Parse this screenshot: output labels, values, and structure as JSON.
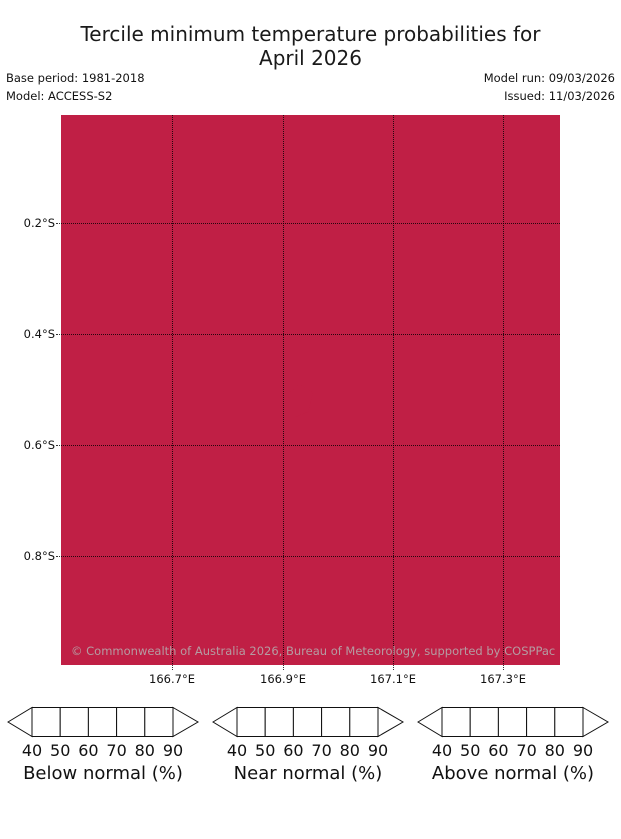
{
  "title": {
    "line1": "Tercile minimum temperature probabilities for",
    "line2": "April 2026"
  },
  "meta": {
    "base_period": "Base period: 1981-2018",
    "model": "Model: ACCESS-S2",
    "model_run": "Model run: 09/03/2026",
    "issued": "Issued: 11/03/2026"
  },
  "map": {
    "fill_color": "#c01f45",
    "outline_color": "#23131a",
    "attribution": "© Commonwealth of Australia 2026, Bureau of Meteorology, supported by COSPPac",
    "y_ticks": [
      "0.2°S",
      "0.4°S",
      "0.6°S",
      "0.8°S"
    ],
    "x_ticks": [
      "166.7°E",
      "166.9°E",
      "167.1°E",
      "167.3°E"
    ],
    "island": "Nauru coastline outline"
  },
  "legend": {
    "ticks": [
      "40",
      "50",
      "60",
      "70",
      "80",
      "90"
    ],
    "below": {
      "label": "Below normal (%)",
      "colors": [
        "#c9dbdf",
        "#abc9d1",
        "#8fbac6",
        "#6fa9b8",
        "#4d9aad"
      ],
      "arrow": "#2f8fa3"
    },
    "near": {
      "label": "Near normal (%)",
      "colors": [
        "#ececec",
        "#dedede",
        "#cecece",
        "#b5b5b5",
        "#9c9c9c"
      ],
      "arrow": "#7f7f7f"
    },
    "above": {
      "label": "Above normal (%)",
      "colors": [
        "#dcb1bd",
        "#d598a8",
        "#cd8093",
        "#c5657c",
        "#c04061"
      ],
      "arrow": "#c01f45"
    }
  },
  "chart_data": {
    "type": "heatmap",
    "title": "Tercile minimum temperature probabilities for April 2026",
    "subtitle_meta": {
      "base_period": "1981-2018",
      "model": "ACCESS-S2",
      "model_run": "09/03/2026",
      "issued": "11/03/2026"
    },
    "region": "Nauru and surrounding ocean",
    "x": {
      "label": "Longitude",
      "ticks": [
        166.7,
        166.9,
        167.1,
        167.3
      ],
      "tick_suffix": "°E",
      "range": [
        166.5,
        167.4
      ]
    },
    "y": {
      "label": "Latitude",
      "ticks": [
        0.2,
        0.4,
        0.6,
        0.8
      ],
      "tick_suffix": "°S",
      "range": [
        0.0,
        1.0
      ]
    },
    "field": "tercile category probability of minimum temperature",
    "uniform_value": "Above normal, >90% probability over entire mapped area",
    "grid": true,
    "legend_position": "bottom",
    "colorbars": [
      {
        "name": "Below normal (%)",
        "ticks": [
          40,
          50,
          60,
          70,
          80,
          90
        ]
      },
      {
        "name": "Near normal (%)",
        "ticks": [
          40,
          50,
          60,
          70,
          80,
          90
        ]
      },
      {
        "name": "Above normal (%)",
        "ticks": [
          40,
          50,
          60,
          70,
          80,
          90
        ]
      }
    ],
    "attribution": "© Commonwealth of Australia 2026, Bureau of Meteorology, supported by COSPPac"
  }
}
